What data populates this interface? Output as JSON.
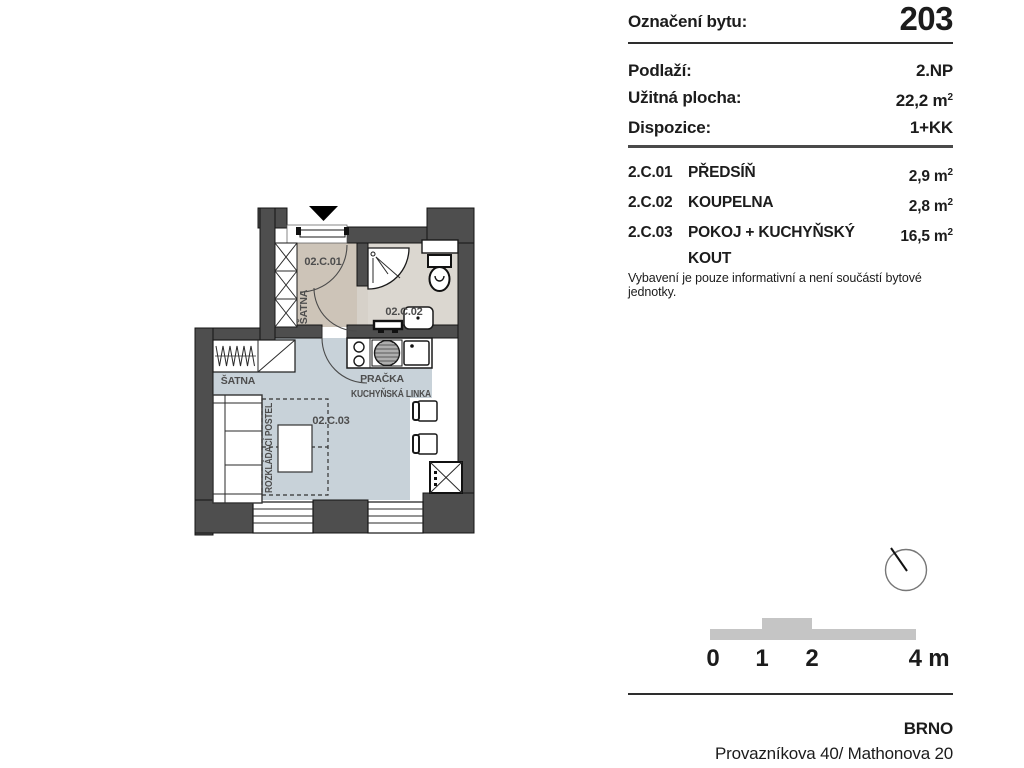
{
  "panel": {
    "unit_label": "Označení bytu:",
    "unit_number": "203",
    "rows": [
      {
        "label": "Podlaží:",
        "value": "2.NP"
      },
      {
        "label": "Užitná plocha:",
        "value": "22,2 m",
        "sup": "2"
      },
      {
        "label": "Dispozice:",
        "value": "1+KK"
      }
    ],
    "rooms": [
      {
        "code": "2.C.01",
        "name": "PŘEDSÍŇ",
        "area": "2,9 m",
        "sup": "2"
      },
      {
        "code": "2.C.02",
        "name": "KOUPELNA",
        "area": "2,8 m",
        "sup": "2"
      },
      {
        "code": "2.C.03",
        "name": "POKOJ + KUCHYŇSKÝ KOUT",
        "area": "16,5 m",
        "sup": "2"
      }
    ],
    "note": "Vybavení je pouze informativní a není součástí bytové jednotky."
  },
  "plan": {
    "labels": {
      "hall_code": "02.C.01",
      "hall_wardrobe": "ŠATNA",
      "bath_code": "02.C.02",
      "room_code": "02.C.03",
      "room_wardrobe": "ŠATNA",
      "washer": "PRAČKA",
      "kitchen_unit": "KUCHYŇSKÁ LINKA",
      "folding_bed": "ROZKLÁDACÍ POSTEL"
    },
    "colors": {
      "wall": "#4e4e4e",
      "hall_floor": "#cdc4b8",
      "bath_floor": "#dbd7d0",
      "room_floor": "#c8d2d9"
    }
  },
  "scalebar": {
    "ticks": [
      "0",
      "1",
      "2",
      "4 m"
    ]
  },
  "footer": {
    "city": "BRNO",
    "address": "Provazníkova 40/ Mathonova 20"
  }
}
